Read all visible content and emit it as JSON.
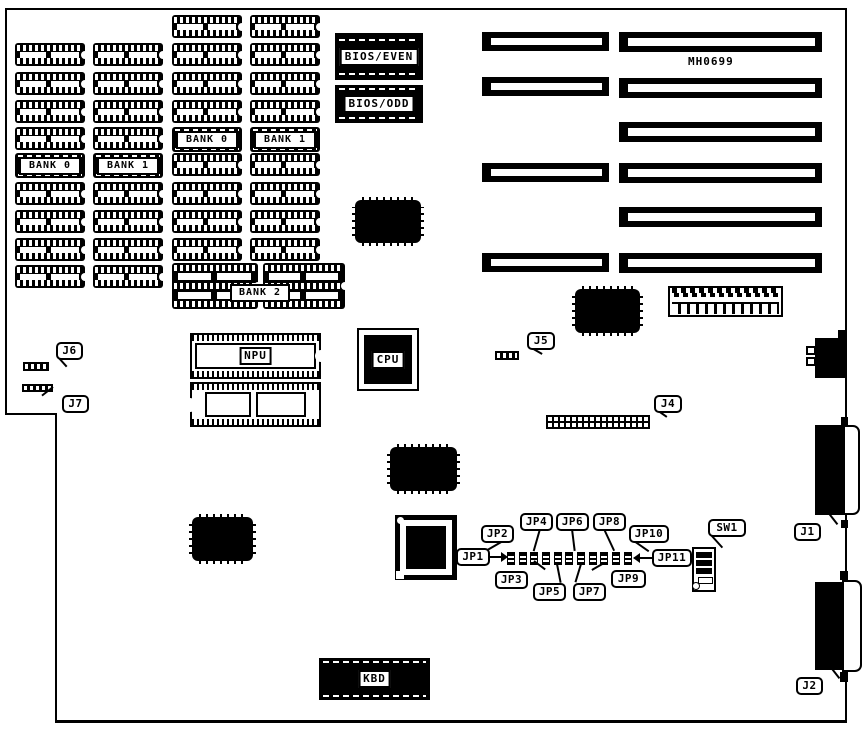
{
  "board": {
    "part_number": "MH0699"
  },
  "memory": {
    "bank0": "BANK 0",
    "bank1": "BANK 1",
    "bank2": "BANK 2"
  },
  "chips": {
    "bios_even": "BIOS/EVEN",
    "bios_odd": "BIOS/ODD",
    "npu": "NPU",
    "cpu": "CPU",
    "kbd": "KBD"
  },
  "connectors": {
    "j1": "J1",
    "j2": "J2",
    "j4": "J4",
    "j5": "J5",
    "j6": "J6",
    "j7": "J7"
  },
  "jumpers": {
    "jp1": "JP1",
    "jp2": "JP2",
    "jp3": "JP3",
    "jp4": "JP4",
    "jp5": "JP5",
    "jp6": "JP6",
    "jp7": "JP7",
    "jp8": "JP8",
    "jp9": "JP9",
    "jp10": "JP10",
    "jp11": "JP11"
  },
  "switches": {
    "sw1": "SW1"
  },
  "colors": {
    "ink": "#000000",
    "paper": "#ffffff"
  }
}
